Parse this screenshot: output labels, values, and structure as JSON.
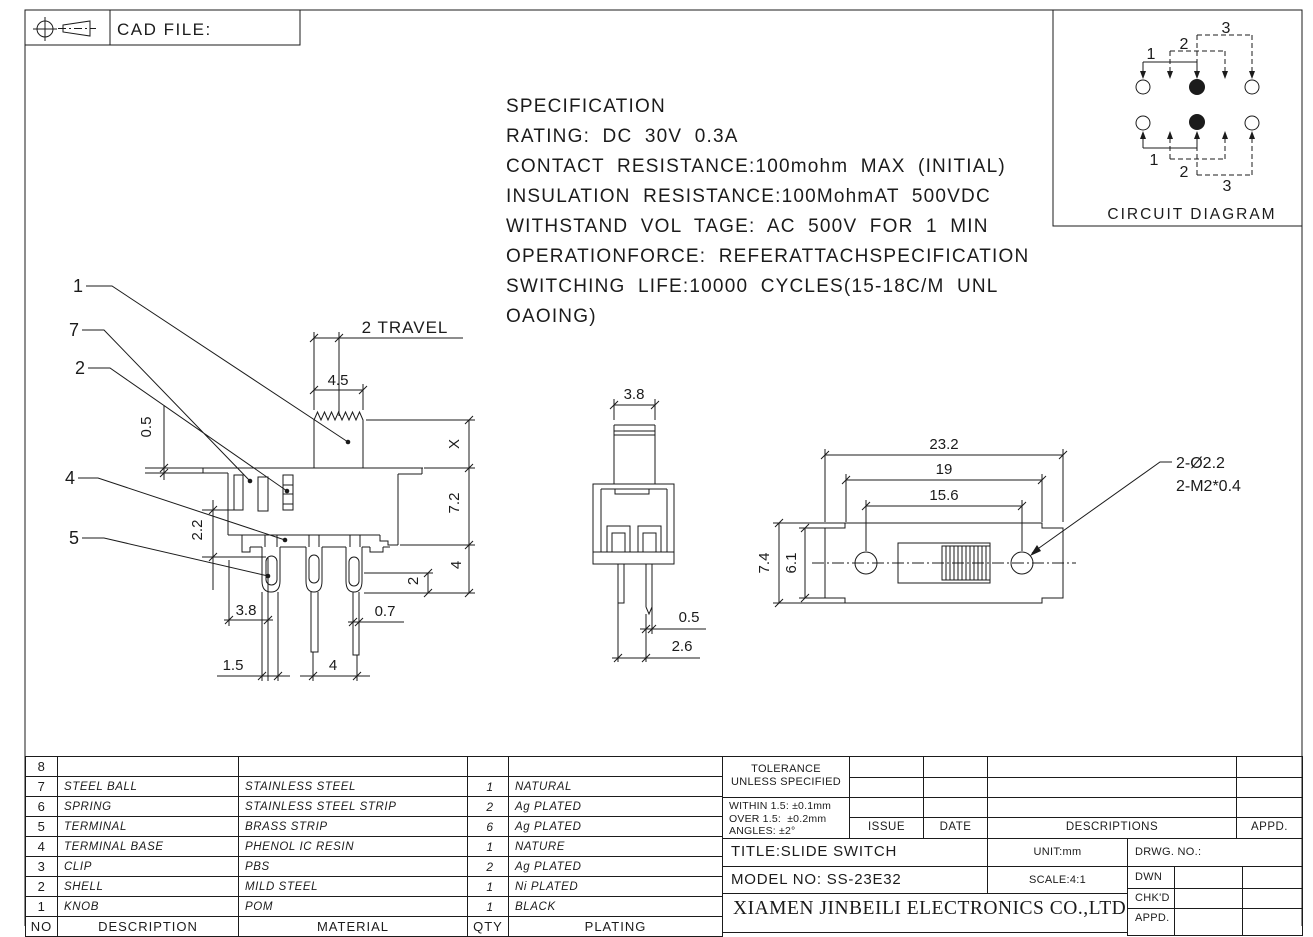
{
  "colors": {
    "line": "#1b1b1b",
    "background": "#ffffff"
  },
  "frame": {
    "cad_file_label": "CAD FILE:"
  },
  "spec": {
    "lines": [
      "SPECIFICATION",
      "RATING: DC 30V 0.3A",
      "CONTACT RESISTANCE:100mohm MAX (INITIAL)",
      "INSULATION RESISTANCE:100MohmAT 500VDC",
      "WITHSTAND VOL TAGE: AC 500V FOR 1 MIN",
      "OPERATIONFORCE: REFERATTACHSPECIFICATION",
      "SWITCHING LIFE:10000 CYCLES(15-18C/M UNL",
      "OAOING)"
    ]
  },
  "circuit": {
    "title": "CIRCUIT DIAGRAM",
    "labels": {
      "t1": "1",
      "t2": "2",
      "t3": "3",
      "b1": "1",
      "b2": "2",
      "b3": "3"
    }
  },
  "front_view": {
    "callouts": {
      "knob": "1",
      "steel_ball": "7",
      "spring": "2",
      "base": "4",
      "terminal": "5"
    },
    "dims": {
      "travel": "2 TRAVEL",
      "knob_width": "4.5",
      "flange": "0.5",
      "height_x": "X",
      "body_height": "7.2",
      "terminal_length": "4",
      "tip": "2",
      "slot_depth": "2.2",
      "d38": "3.8",
      "pin_width": "0.7",
      "d15": "1.5",
      "pitch": "4"
    }
  },
  "side_view": {
    "dims": {
      "knob_width": "3.8",
      "pin_width": "0.5",
      "pin_pitch": "2.6"
    }
  },
  "top_view": {
    "dims": {
      "overall": "23.2",
      "mid": "19",
      "holes": "15.6",
      "height": "7.4",
      "inner_height": "6.1"
    },
    "hole_note_1": "2-Ø2.2",
    "hole_note_2": "2-M2*0.4"
  },
  "bom": {
    "headers": {
      "no": "NO",
      "description": "DESCRIPTION",
      "material": "MATERIAL",
      "qty": "QTY",
      "plating": "PLATING"
    },
    "rows": [
      {
        "no": "8",
        "description": "",
        "material": "",
        "qty": "",
        "plating": ""
      },
      {
        "no": "7",
        "description": "STEEL BALL",
        "material": "STAINLESS STEEL",
        "qty": "1",
        "plating": "NATURAL"
      },
      {
        "no": "6",
        "description": "SPRING",
        "material": "STAINLESS STEEL STRIP",
        "qty": "2",
        "plating": "Ag PLATED"
      },
      {
        "no": "5",
        "description": "TERMINAL",
        "material": "BRASS STRIP",
        "qty": "6",
        "plating": "Ag PLATED"
      },
      {
        "no": "4",
        "description": "TERMINAL BASE",
        "material": "PHENOL IC RESIN",
        "qty": "1",
        "plating": "NATURE"
      },
      {
        "no": "3",
        "description": "CLIP",
        "material": "PBS",
        "qty": "2",
        "plating": "Ag PLATED"
      },
      {
        "no": "2",
        "description": "SHELL",
        "material": "MILD STEEL",
        "qty": "1",
        "plating": "Ni PLATED"
      },
      {
        "no": "1",
        "description": "KNOB",
        "material": "POM",
        "qty": "1",
        "plating": "BLACK"
      }
    ]
  },
  "title_block": {
    "tolerance_title_1": "TOLERANCE",
    "tolerance_title_2": "UNLESS SPECIFIED",
    "tolerance_lines": [
      "WITHIN 1.5: ±0.1mm",
      "OVER 1.5:  ±0.2mm",
      "ANGLES: ±2°"
    ],
    "rev_headers": {
      "issue": "ISSUE",
      "date": "DATE",
      "descriptions": "DESCRIPTIONS",
      "appd": "APPD."
    },
    "title": "TITLE:SLIDE SWITCH",
    "model": "MODEL NO: SS-23E32",
    "unit": "UNIT:mm",
    "scale": "SCALE:4:1",
    "drwg": "DRWG. NO.:",
    "sign_rows": {
      "dwn": "DWN",
      "chkd": "CHK'D",
      "appd": "APPD."
    },
    "company": "XIAMEN JINBEILI ELECTRONICS CO.,LTD"
  }
}
